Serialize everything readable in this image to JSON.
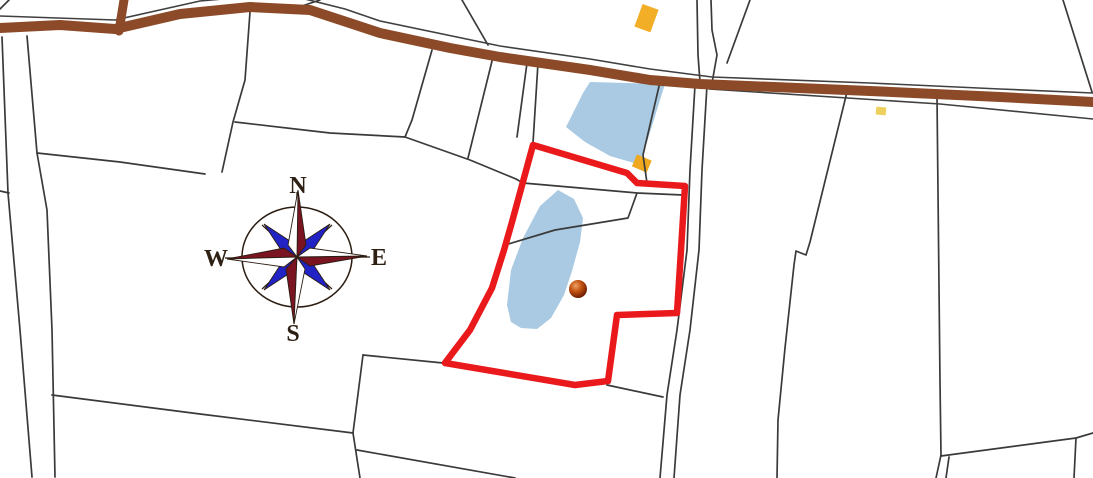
{
  "compass": {
    "labels": {
      "north": "N",
      "east": "E",
      "south": "S",
      "west": "W"
    }
  },
  "colors": {
    "background": "#ffffff",
    "parcel_line": "#3a3a3a",
    "road": "#8c4a28",
    "road_casing": "#404040",
    "boundary_red": "#ea1a1c",
    "water": "#a9cae2",
    "building_large": "#f2ae27",
    "building_pond": "#f0a81f",
    "building_small": "#eed05c",
    "compass_cardinal": "#7a1420",
    "compass_cardinal_light": "#ffffff",
    "compass_intercardinal": "#2223c4",
    "compass_outline": "#2b1d12",
    "compass_letter": "#2e2114",
    "marker_core": "#5c1202",
    "marker_mid": "#c0500f",
    "marker_highlight": "#f0a065"
  }
}
